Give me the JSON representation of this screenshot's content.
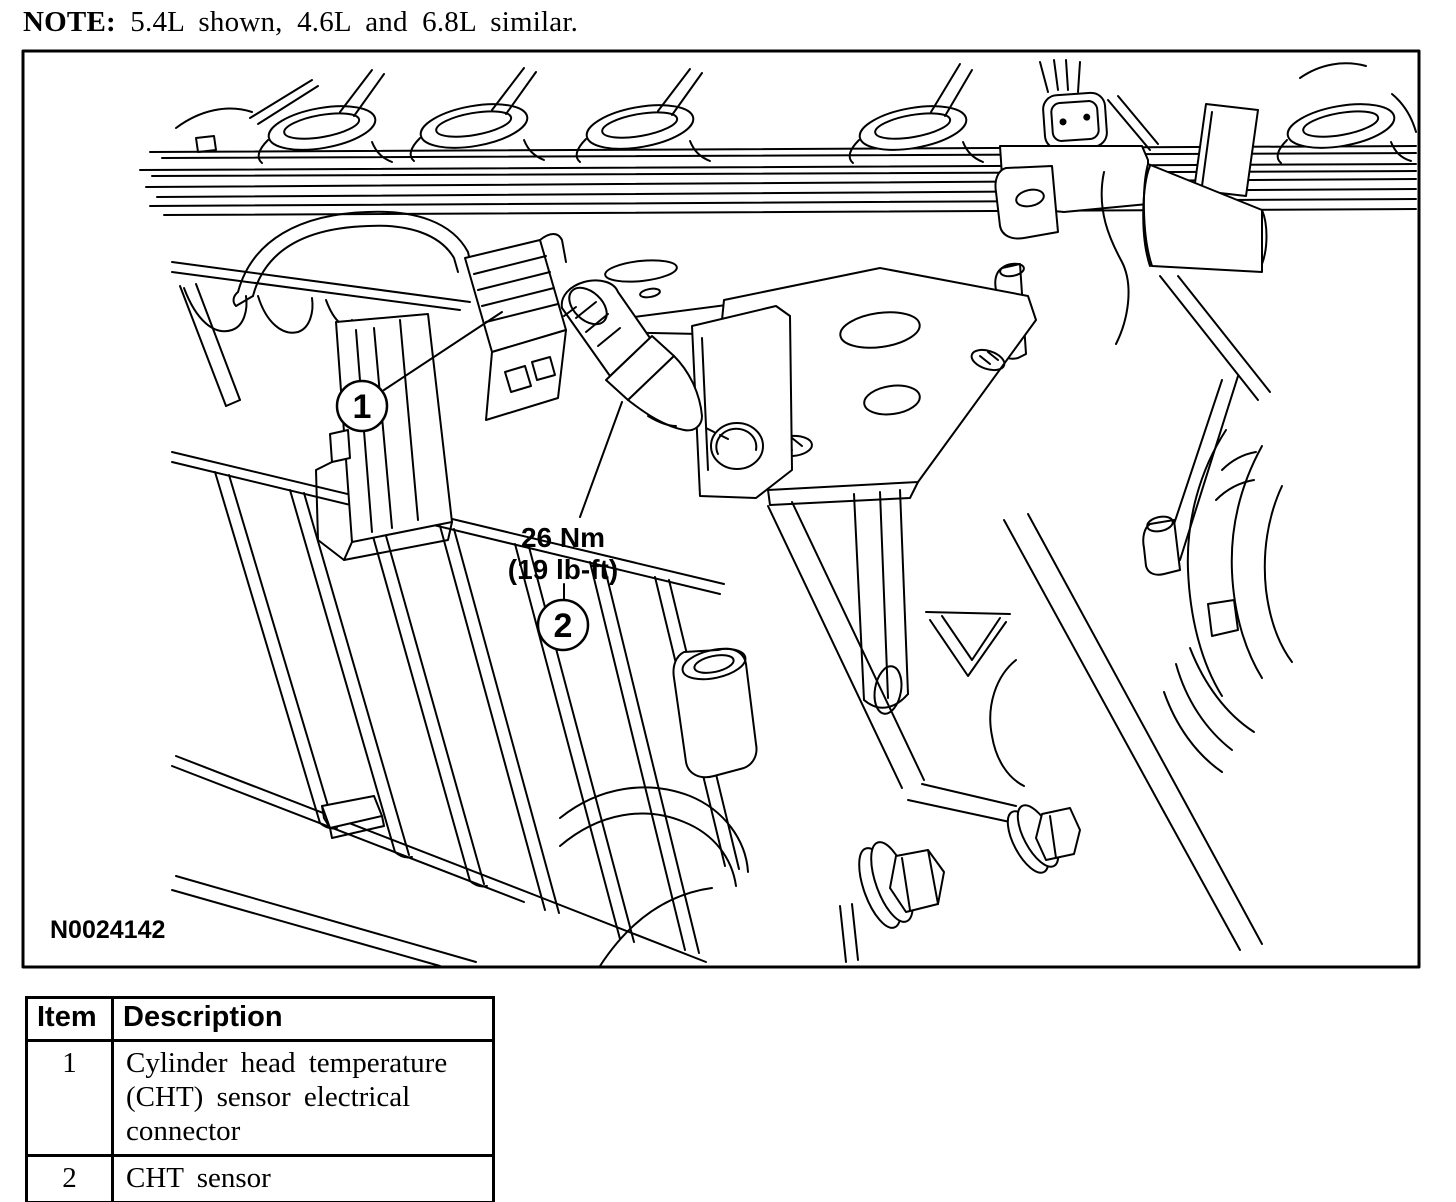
{
  "note": {
    "label": "NOTE:",
    "text": "5.4L shown, 4.6L and 6.8L similar."
  },
  "figure": {
    "figure_id": "N0024142",
    "torque_label": {
      "line1": "26 Nm",
      "line2": "(19 lb-ft)"
    },
    "callouts": [
      {
        "number": "1"
      },
      {
        "number": "2"
      }
    ]
  },
  "parts_table": {
    "headers": [
      "Item",
      "Description"
    ],
    "rows": [
      {
        "item": "1",
        "description": "Cylinder head temperature (CHT) sensor electrical connector"
      },
      {
        "item": "2",
        "description": "CHT sensor"
      }
    ]
  },
  "colors": {
    "line": "#000000",
    "background": "#ffffff"
  }
}
